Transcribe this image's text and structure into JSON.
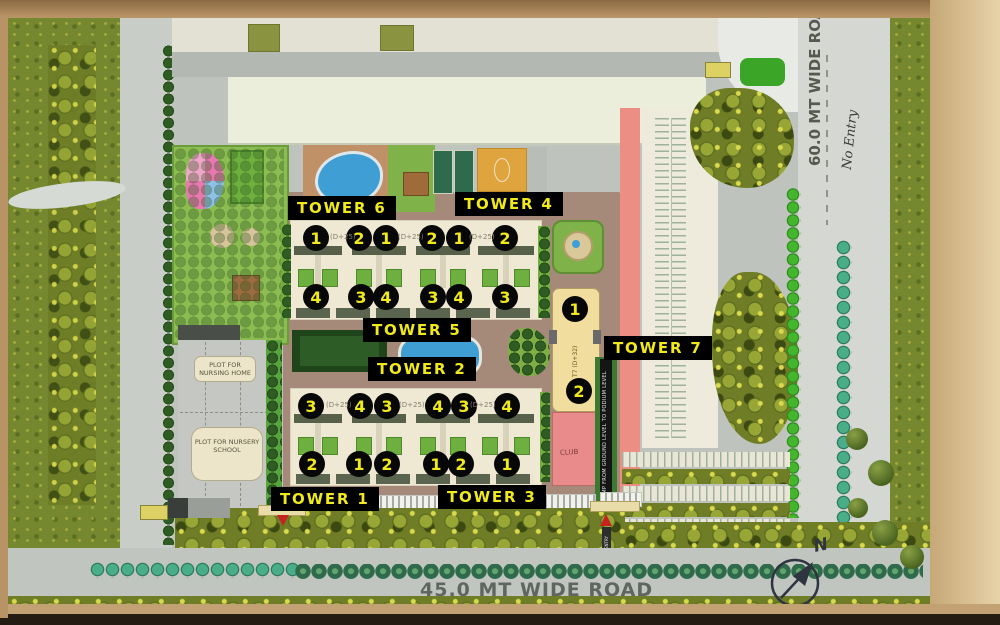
{
  "palette": {
    "label_bg": "#000000",
    "label_text": "#f0ea1c",
    "arrow_red": "#c42320",
    "club_pink": "#e98b8b",
    "tower7_fill": "#f1dd9e",
    "pool_blue": "#3f9fd4",
    "frame_tan": "#c7a977",
    "field_olive": "#76882f",
    "road_gray": "#c1c5bf"
  },
  "roads": {
    "right_vertical": "60.0 MT WIDE ROAD",
    "bottom_horizontal": "45.0 MT WIDE ROAD",
    "handwritten_note": "No Entry"
  },
  "plots": {
    "nursing_home": "PLOT FOR NURSING HOME",
    "nursery_school": "PLOT FOR NURSERY SCHOOL"
  },
  "towers": {
    "t1": "TOWER 1",
    "t2": "TOWER 2",
    "t3": "TOWER 3",
    "t4": "TOWER 4",
    "t5": "TOWER 5",
    "t6": "TOWER 6",
    "t7": "TOWER 7"
  },
  "annotations": {
    "tower7_core": "T7 (D+32)",
    "club": "CLUB",
    "ramp": "RAMP FROM GROUND LEVEL TO PODIUM LEVEL",
    "floor_note": "(D+25)",
    "gate_entry": "ENTRY",
    "compass_north": "N"
  },
  "units": {
    "upper_top": [
      "1",
      "2",
      "1",
      "2",
      "1",
      "2"
    ],
    "upper_bottom": [
      "4",
      "3",
      "4",
      "3",
      "4",
      "3"
    ],
    "lower_top": [
      "3",
      "4",
      "3",
      "4",
      "3",
      "4"
    ],
    "lower_bottom": [
      "2",
      "1",
      "2",
      "1",
      "2",
      "1"
    ],
    "tower7": [
      "1",
      "2"
    ]
  }
}
